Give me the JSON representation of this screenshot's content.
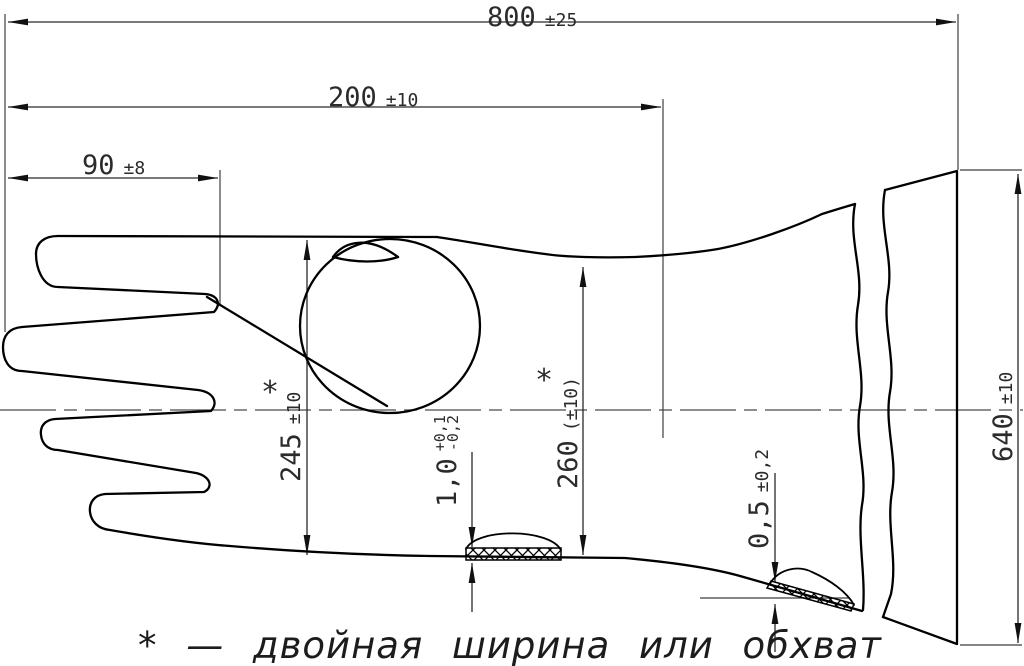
{
  "drawing": {
    "type": "technical-drawing-glove",
    "line_color": "#000000",
    "background": "#ffffff",
    "footnote": "* — двойная ширина или обхват"
  },
  "dimensions": {
    "overall_length": {
      "value": "800",
      "tol": "±25"
    },
    "length_to_wrist": {
      "value": "200",
      "tol": "±10"
    },
    "finger_length": {
      "value": "90",
      "tol": "±8"
    },
    "hand_width": {
      "value": "245",
      "tol": "±10",
      "marker": "*"
    },
    "wrist_width": {
      "value": "260",
      "tol": "(±10)",
      "marker": "*"
    },
    "palm_thickness": {
      "value": "1,0",
      "tol_plus": "+0,1",
      "tol_minus": "-0,2"
    },
    "cuff_thickness": {
      "value": "0,5",
      "tol": "±0,2"
    },
    "cuff_width": {
      "value": "640",
      "tol": "±10"
    }
  }
}
